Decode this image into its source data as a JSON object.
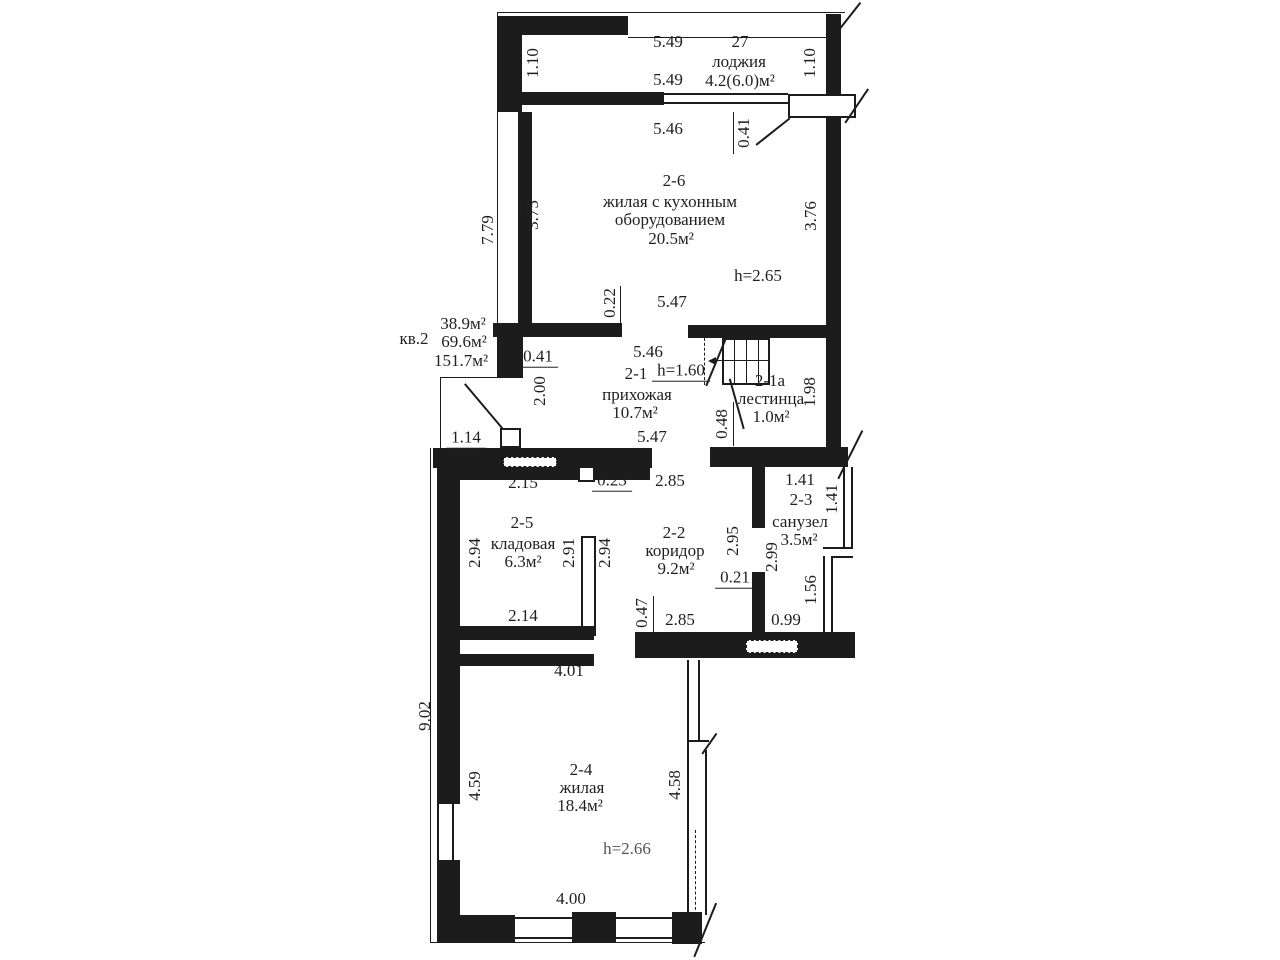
{
  "apartment": {
    "label": "кв.2",
    "area_lines": [
      "38.9м²",
      "69.6м²",
      "151.7м²"
    ]
  },
  "rooms": {
    "loggia": {
      "number": "27",
      "name": "лоджия",
      "area": "4.2(6.0)м²"
    },
    "r2_6": {
      "number": "2-6",
      "name_line1": "жилая с кухонным",
      "name_line2": "оборудованием",
      "area": "20.5м²",
      "height": "h=2.65"
    },
    "r2_1": {
      "number": "2-1",
      "name": "прихожая",
      "area": "10.7м²",
      "height": "h=1.60"
    },
    "r2_1a": {
      "number": "2-1а",
      "name": "лестинца",
      "area": "1.0м²"
    },
    "r2_5": {
      "number": "2-5",
      "name": "кладовая",
      "area": "6.3м²"
    },
    "r2_2": {
      "number": "2-2",
      "name": "коридор",
      "area": "9.2м²"
    },
    "r2_3": {
      "number": "2-3",
      "name": "санузел",
      "area": "3.5м²"
    },
    "r2_4": {
      "number": "2-4",
      "name": "жилая",
      "area": "18.4м²",
      "height": "h=2.66"
    }
  },
  "dims": {
    "top_width_a": "5.49",
    "top_total": "27",
    "top_width_b": "5.49",
    "loggia_depth_left": "1.10",
    "loggia_depth_right": "1.10",
    "r26_top_width": "5.46",
    "r26_wall_offset": "0.41",
    "left_height_upper": "7.79",
    "r26_left": "3.75",
    "r26_right": "3.76",
    "r26_wall_stub": "0.22",
    "r26_bottom_width": "5.47",
    "kv_wall": "0.41",
    "hall_offset": "2.00",
    "hall_top_width": "5.46",
    "stair_height": "1.98",
    "stair_offset": "0.48",
    "hall_bottom_width": "5.47",
    "left_step": "1.14",
    "r25_top": "2.15",
    "r25_door": "0.23",
    "r22_top": "2.85",
    "r25_left": "2.94",
    "r25_inner": "2.91",
    "r25_right": "2.94",
    "r25_bottom": "2.14",
    "r22_left": "2.95",
    "r22_right": "2.99",
    "r22_stub": "0.21",
    "r22_offset": "0.47",
    "r22_bottom": "2.85",
    "r22_niche": "0.99",
    "r23_top": "1.41",
    "r23_right": "1.41",
    "r23_lower": "1.56",
    "r24_top": "4.01",
    "left_height_lower": "9.02",
    "r24_left": "4.59",
    "r24_right": "4.58",
    "r24_bottom": "4.00"
  }
}
